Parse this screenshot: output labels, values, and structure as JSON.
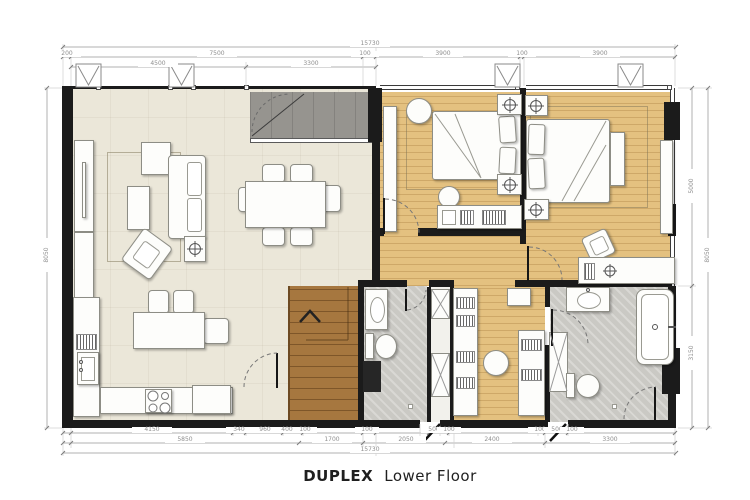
{
  "title": {
    "main": "DUPLEX",
    "sub": "Lower Floor"
  },
  "dims": {
    "top_overall": "15730",
    "top_row2": [
      "200",
      "7500",
      "100",
      "3900",
      "100",
      "3900"
    ],
    "top_row3": [
      "4500",
      "3300"
    ],
    "bottom_row1": [
      "4150",
      "340",
      "960",
      "400",
      "100",
      "100",
      "500",
      "100",
      "100",
      "500",
      "100"
    ],
    "bottom_row2": [
      "5850",
      "1700",
      "2050",
      "2400",
      "3300"
    ],
    "bottom_overall": "15730",
    "left_overall": "8050",
    "right_top": "5000",
    "right_bottom": "3150",
    "right_overall": "8050"
  },
  "colors": {
    "wall": "#1b1b1b",
    "living_floor": "#ebe7d9",
    "wood_floor": "#e4c180",
    "stair_wood": "#a6773f",
    "bath_floor": "#cac9c4",
    "void_gray": "#96948f"
  }
}
